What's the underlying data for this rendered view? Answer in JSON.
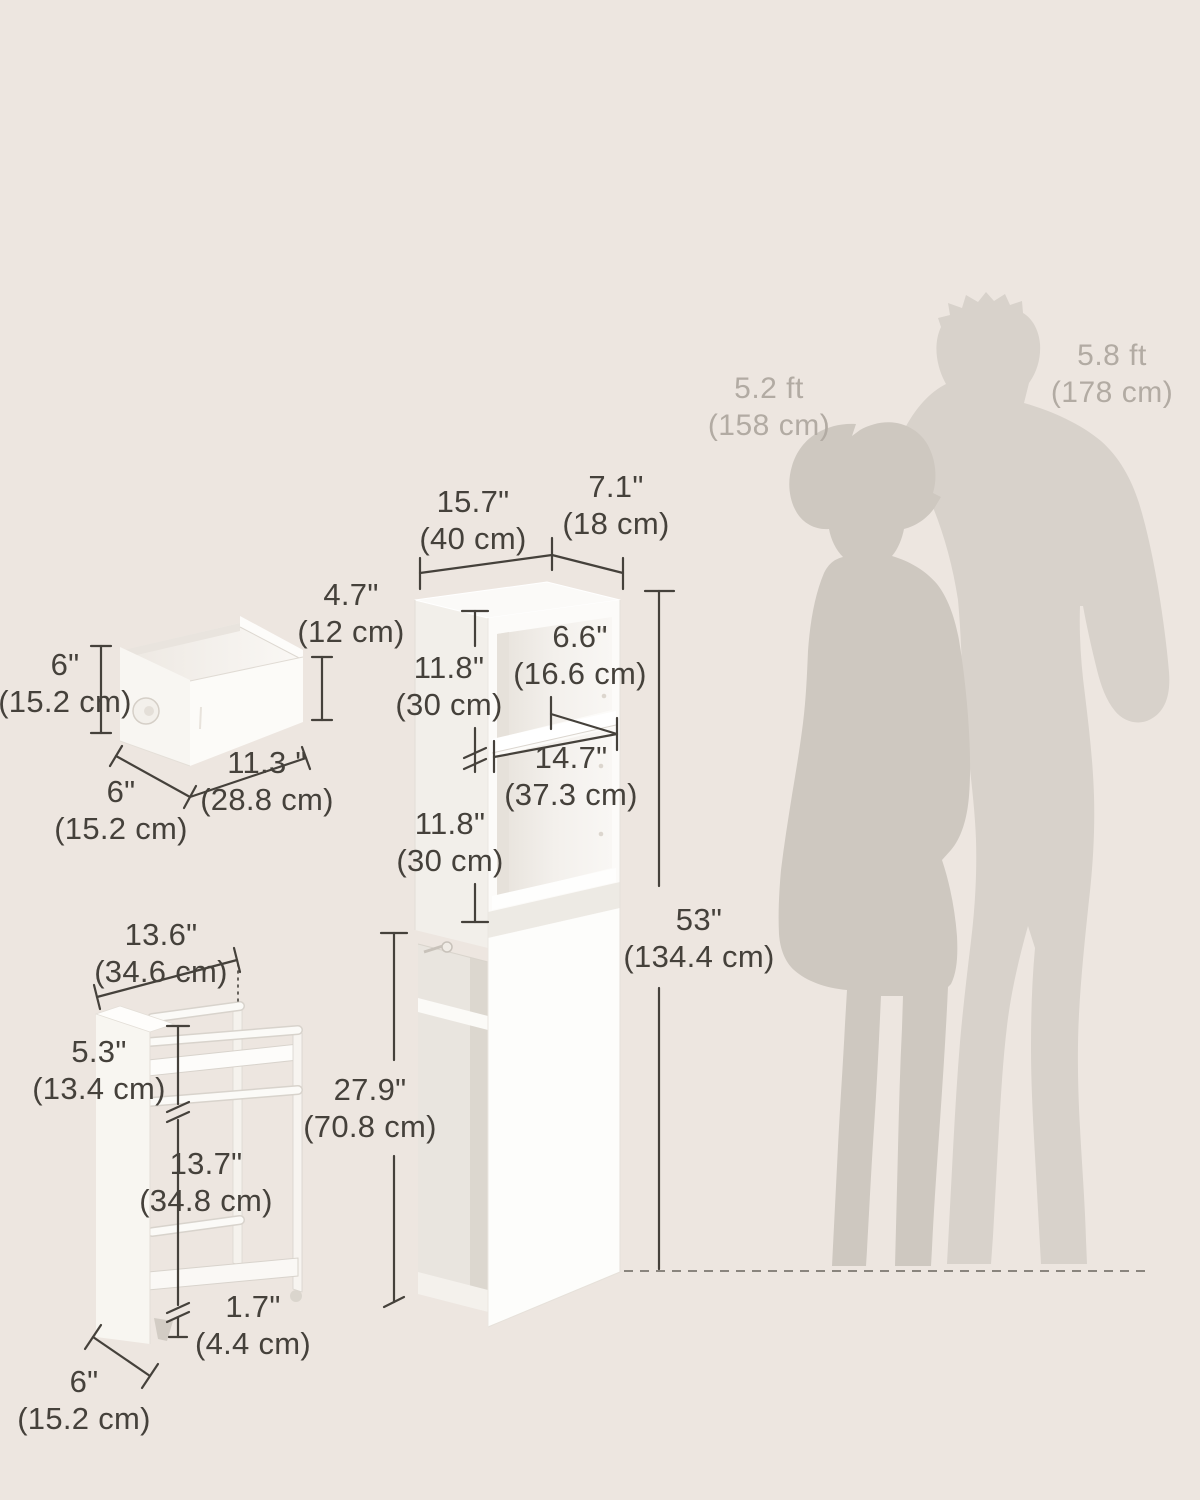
{
  "people": {
    "woman": {
      "height_ft": "5.2 ft",
      "height_cm": "(158 cm)"
    },
    "man": {
      "height_ft": "5.8 ft",
      "height_cm": "(178 cm)"
    }
  },
  "cabinet": {
    "width": {
      "in": "15.7\"",
      "cm": "(40 cm)"
    },
    "depth": {
      "in": "7.1\"",
      "cm": "(18 cm)"
    },
    "upper_compartment": {
      "in": "11.8\"",
      "cm": "(30 cm)"
    },
    "shelf_depth": {
      "in": "6.6\"",
      "cm": "(16.6 cm)"
    },
    "shelf_width": {
      "in": "14.7\"",
      "cm": "(37.3 cm)"
    },
    "second_compartment": {
      "in": "11.8\"",
      "cm": "(30 cm)"
    },
    "lower_section": {
      "in": "27.9\"",
      "cm": "(70.8 cm)"
    },
    "total_height": {
      "in": "53\"",
      "cm": "(134.4 cm)"
    }
  },
  "drawer": {
    "front_height": {
      "in": "6\"",
      "cm": "(15.2 cm)"
    },
    "inner_height": {
      "in": "4.7\"",
      "cm": "(12 cm)"
    },
    "width": {
      "in": "11.3 \"",
      "cm": "(28.8 cm)"
    },
    "depth": {
      "in": "6\"",
      "cm": "(15.2 cm)"
    }
  },
  "cart": {
    "width": {
      "in": "13.6\"",
      "cm": "(34.6 cm)"
    },
    "top_section": {
      "in": "5.3\"",
      "cm": "(13.4 cm)"
    },
    "middle_section": {
      "in": "13.7\"",
      "cm": "(34.8 cm)"
    },
    "caster_height": {
      "in": "1.7\"",
      "cm": "(4.4 cm)"
    },
    "depth": {
      "in": "6\"",
      "cm": "(15.2 cm)"
    }
  },
  "colors": {
    "background": "#EDE6E0",
    "dimension_text": "#45413B",
    "dimension_line": "#45413B",
    "person_label_text": "#B2ABA3",
    "man_silhouette": "#D8D2CB",
    "woman_silhouette": "#CEC8C0",
    "furniture_white": "#FDFDFB",
    "floor_dash": "#8A857E"
  }
}
